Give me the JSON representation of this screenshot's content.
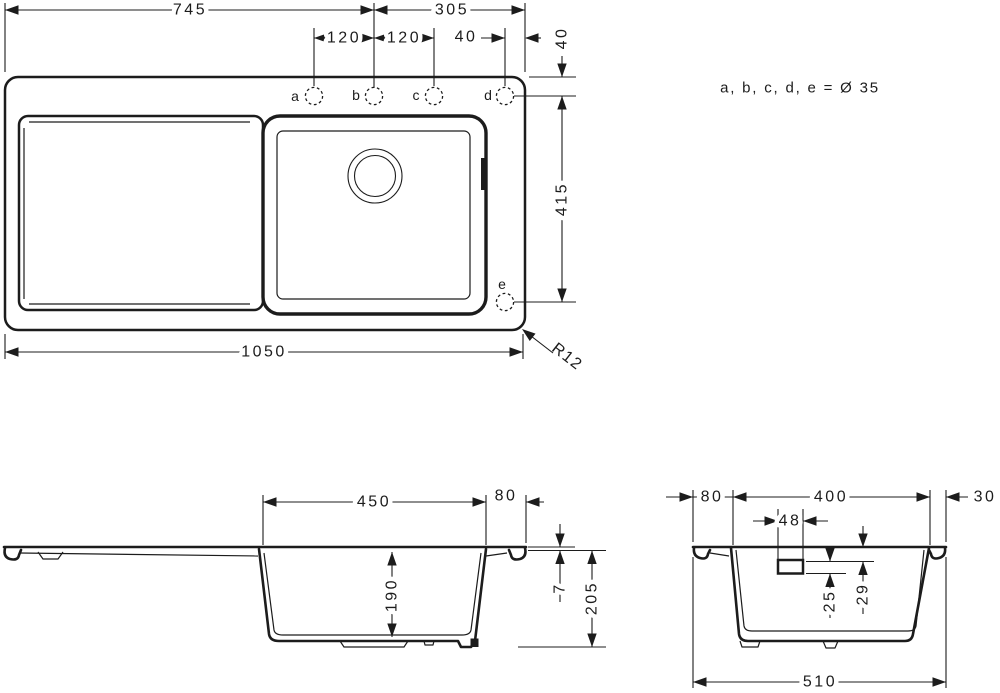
{
  "note": "a, b, c, d, e = Ø 35",
  "plan": {
    "d745": "745",
    "d305": "305",
    "d120a": "120",
    "d120b": "120",
    "d40h": "40",
    "d40v": "40",
    "d415": "415",
    "d1050": "1050",
    "r12": "R12",
    "holes": {
      "a": "a",
      "b": "b",
      "c": "c",
      "d": "d",
      "e": "e"
    }
  },
  "front": {
    "d450": "450",
    "d80": "80",
    "d190": "190",
    "d7": "7",
    "d205": "205"
  },
  "side": {
    "d80": "80",
    "d400": "400",
    "d30": "30",
    "d48": "48",
    "d25": "25",
    "d29": "29",
    "d510": "510"
  },
  "colors": {
    "line": "#1c1c1c",
    "bg": "#ffffff"
  }
}
